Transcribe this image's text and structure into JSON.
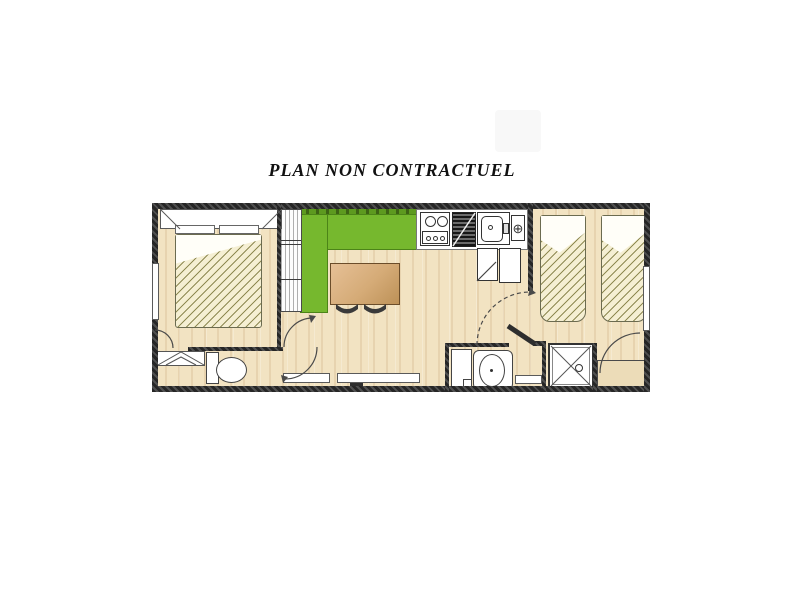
{
  "title": {
    "text": "PLAN NON CONTRACTUEL"
  },
  "colors": {
    "floor": "#f2e3c2",
    "wall": "#3a3a3a",
    "bench_green": "#76b82e",
    "bench_green_dark": "#5d9a1f",
    "bed_hatch_bg": "#f5efd3",
    "hatch_line": "#7d783c",
    "table_light": "#e6c096",
    "table_dark": "#bd9157",
    "fixture_white": "#ffffff",
    "outline": "#4a4a4a"
  },
  "plan": {
    "kind": "mobile-home-floor-plan",
    "rooms": [
      {
        "name": "bedroom-1"
      },
      {
        "name": "living-kitchen"
      },
      {
        "name": "wc"
      },
      {
        "name": "hallway"
      },
      {
        "name": "bathroom"
      },
      {
        "name": "shower-room"
      },
      {
        "name": "bedroom-2"
      }
    ],
    "fixtures": {
      "bedroom_1": [
        "overhead-cabinet",
        "pillows",
        "double-bed",
        "wardrobe"
      ],
      "living_kitchen": [
        "kitchen-bench-green",
        "dining-table",
        "chairs",
        "stove",
        "draining-board",
        "sink",
        "water-heater",
        "fridge-cabinets"
      ],
      "wc": [
        "shelf-unit",
        "toilet"
      ],
      "bathroom": [
        "tall-cabinet",
        "washbasin-vanity"
      ],
      "shower_room": [
        "shower-tray"
      ],
      "bedroom_2": [
        "twin-bed-left",
        "twin-bed-right",
        "bedside-cabinet"
      ]
    },
    "window_count": 5,
    "door_count": 5
  },
  "watermark": {
    "visible": true
  }
}
